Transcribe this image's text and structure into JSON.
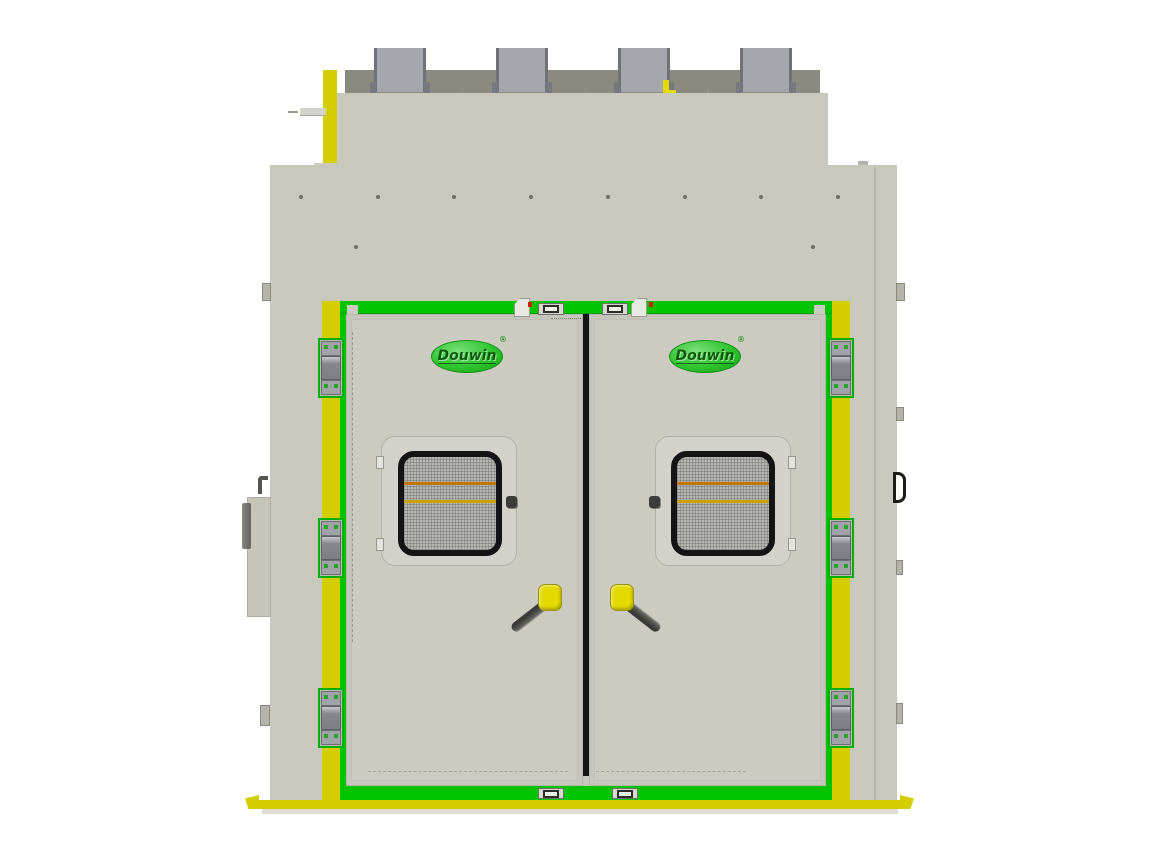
{
  "branding": {
    "left_door_logo": "Douwin",
    "left_door_logo_mark": "®",
    "right_door_logo": "Douwin",
    "right_door_logo_mark": "®"
  },
  "colors": {
    "body_gray": "#c8c8bc",
    "door_gray": "#cbcbc1",
    "roof_band_gray": "#8a8a80",
    "exhaust_block_gray": "#a4a7ab",
    "exhaust_block_edge": "#6f7276",
    "frame_green": "#00c400",
    "hinge_green": "#00b000",
    "accent_yellow": "#d4ce00",
    "handle_yellow": "#e2da00",
    "window_mesh_gray": "#b5b5b1",
    "louver_orange_upper": "#c07600",
    "louver_orange_lower": "#c9a000",
    "outline_black": "#141414",
    "logo_green": "#2fc42f",
    "logo_text_green": "#0a5c0a",
    "bolt_gray": "#6f6f67"
  }
}
